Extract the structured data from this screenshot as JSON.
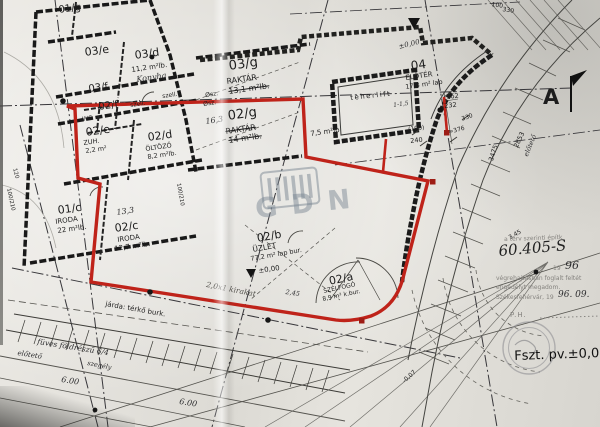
{
  "colors": {
    "outline_red": "#bf231a",
    "ink": "#1c1c1c",
    "paper": "#e8e6e1"
  },
  "plan": {
    "rooms": {
      "r01g": {
        "id": "01/g"
      },
      "r03e": {
        "id": "03/e"
      },
      "r03d": {
        "id": "03/d",
        "area": "11,2 m²lb.",
        "note": "Konyha"
      },
      "r03f": {
        "id": "03/f"
      },
      "r03g": {
        "id": "03/g",
        "name": "RAKTÁR",
        "area": "13,1 m²lb."
      },
      "r02f": {
        "id": "02/f",
        "name": "WC"
      },
      "r02e": {
        "id": "02/e",
        "name": "ZUH.",
        "area": "2,2 m²"
      },
      "r02d": {
        "id": "02/d",
        "name": "ÖLTÖZŐ",
        "area": "8,2 m²lb."
      },
      "r02g": {
        "id": "02/g",
        "name": "RAKTÁR",
        "area": "14 m²lb.",
        "note": "16,3"
      },
      "r01c": {
        "id": "01/c",
        "name": "IRODA",
        "area": "22 m²lb."
      },
      "r02c": {
        "id": "02/c",
        "name": "IRODA",
        "area": "12,7 m²lb.",
        "note": "13,3"
      },
      "r02b": {
        "id": "02/b",
        "name": "ÜZLET",
        "area": "77,2 m² lap bur."
      },
      "r02a": {
        "id": "02/a",
        "name": "SZÉLFOGÓ",
        "area": "8,9 m² k.bur."
      },
      "r04": {
        "id": "04",
        "name": "ELŐTÉR",
        "area": "17,3 m² lap"
      },
      "annex": {
        "area": "7,5 m²lb"
      }
    },
    "lift_label": "teherlift",
    "section_marker": "A",
    "vent_label": "szell.",
    "vent_label2": "szell.",
    "shaft_label": "Øsz.",
    "shaft_label2": "Øsz."
  },
  "site": {
    "sidewalk": "járda: térkő burk.",
    "grass": "füves földrészű 6/4",
    "canopy": "előtető",
    "canopy_side": "előtető",
    "curb": "szegély",
    "shopwindow": "2,0x1 kirakat",
    "dim_6m_a": "6.00",
    "dim_6m_b": "6.00",
    "level_top": "±0,00",
    "level_mid": "±0,00",
    "level_neg": "-0,07"
  },
  "dims": {
    "d162": "162",
    "d232": "232",
    "d190": "(190)",
    "d240": "240",
    "d330": "330",
    "d376": "≈376",
    "d100": "100",
    "d330t": "330",
    "d3475": "3475",
    "d2853": "2853",
    "d345": "3,45",
    "door_a": "100/210",
    "door_b": "100/210",
    "d120": "120",
    "d115": "1-1,5",
    "d245": "2,45"
  },
  "permit": {
    "faint_top": "a terv szerinti építk",
    "doc_number": "60.405-S",
    "year_small": "19",
    "year": "96",
    "line1": "végrehajtásban foglalt feltét",
    "line2": "engedélyt megadom.",
    "line3": "Székesfehérvár, 19",
    "date": "96. 09.",
    "seal": "P.H.",
    "floor_level": "Fszt. pv.±0,00"
  },
  "watermark": {
    "text": "GDN"
  }
}
